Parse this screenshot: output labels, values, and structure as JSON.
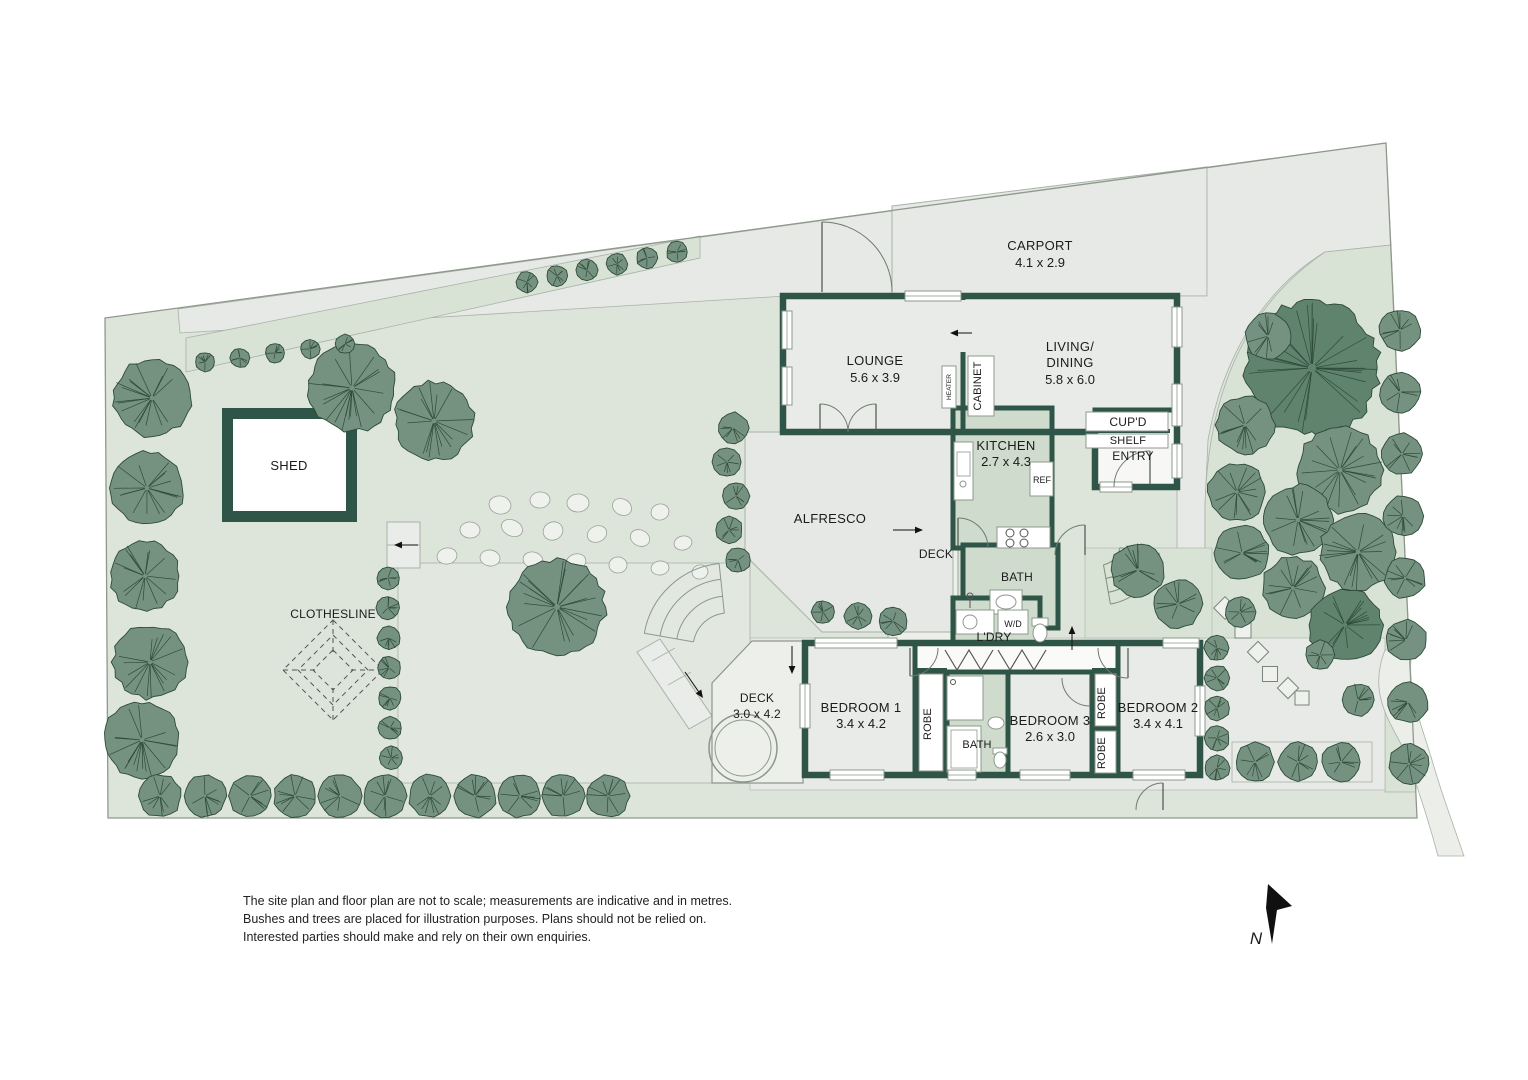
{
  "plan": {
    "carport": {
      "label": "CARPORT",
      "dims": "4.1 x 2.9"
    },
    "lounge": {
      "label": "LOUNGE",
      "dims": "5.6 x 3.9"
    },
    "living_dining": {
      "label1": "LIVING/",
      "label2": "DINING",
      "dims": "5.8 x 6.0"
    },
    "kitchen": {
      "label": "KITCHEN",
      "dims": "2.7 x 4.3"
    },
    "cabinet": {
      "label": "CABINET"
    },
    "heater": {
      "label": "HEATER"
    },
    "ref": {
      "label": "REF"
    },
    "cupboard": {
      "label": "CUP'D"
    },
    "shelf": {
      "label": "SHELF"
    },
    "entry": {
      "label": "ENTRY"
    },
    "alfresco": {
      "label": "ALFRESCO"
    },
    "deck_upper": {
      "label": "DECK"
    },
    "bath": {
      "label": "BATH"
    },
    "wd": {
      "label": "W/D"
    },
    "laundry": {
      "label": "L'DRY"
    },
    "deck_lower": {
      "label": "DECK",
      "dims": "3.0 x 4.2"
    },
    "bedroom1": {
      "label": "BEDROOM 1",
      "dims": "3.4 x 4.2"
    },
    "bedroom2": {
      "label": "BEDROOM 2",
      "dims": "3.4 x 4.1"
    },
    "bedroom3": {
      "label": "BEDROOM 3",
      "dims": "2.6 x 3.0"
    },
    "bath2": {
      "label": "BATH"
    },
    "robe1": {
      "label": "ROBE"
    },
    "robe2": {
      "label": "ROBE"
    },
    "robe3": {
      "label": "ROBE"
    },
    "shed": {
      "label": "SHED"
    },
    "clothesline": {
      "label": "CLOTHESLINE"
    },
    "north": {
      "label": "N"
    }
  },
  "disclaimer": {
    "line1": "The site plan and floor plan are not to scale; measurements are indicative and in metres.",
    "line2": "Bushes and trees are placed for illustration purposes. Plans should not be relied on.",
    "line3": "Interested parties should make and rely on their own enquiries."
  },
  "colors": {
    "wall": "#2e5547",
    "site": "#dde5da",
    "garden_bed": "#d8e2d5",
    "paving": "#e6e9e5",
    "room": "#e9ebe8",
    "wet_area": "#cfdbcd",
    "tree": "#74927f",
    "tree_dark": "#60836e"
  }
}
